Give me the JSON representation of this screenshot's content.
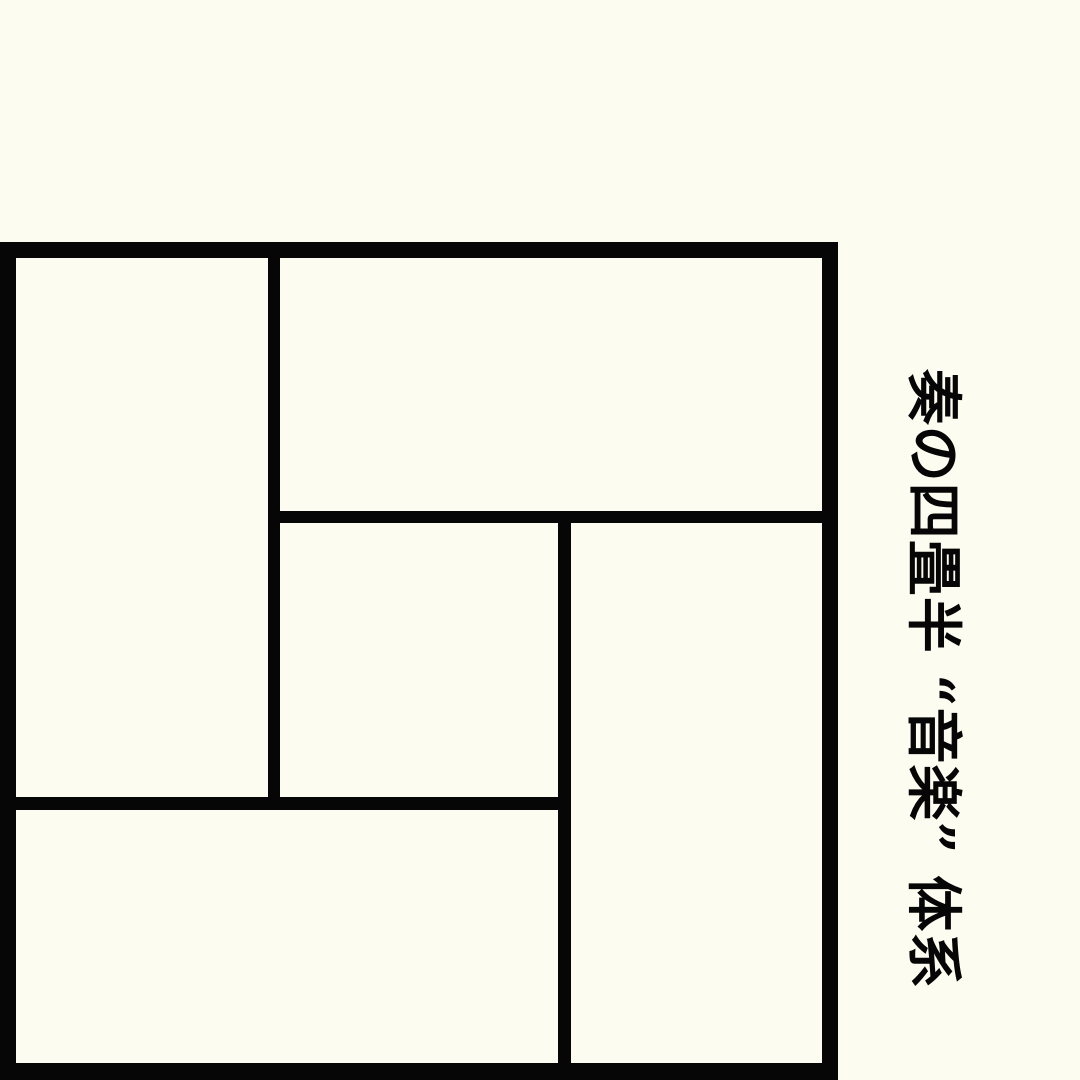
{
  "canvas": {
    "background_color": "#FDFCF0",
    "ink_color": "#060606"
  },
  "title": {
    "text": "奏の四畳半 “音楽” 体系",
    "rotation_deg": 90
  },
  "diagram": {
    "label": "yojohan-tatami-floor-plan",
    "board": {
      "left": 0,
      "top": 242,
      "width": 838,
      "height": 838
    },
    "mats": [
      {
        "name": "mat-left-full",
        "left": 16,
        "top": 16,
        "width": 252,
        "height": 539
      },
      {
        "name": "mat-top-full",
        "left": 280,
        "top": 16,
        "width": 542,
        "height": 253
      },
      {
        "name": "mat-center-half",
        "left": 280,
        "top": 281,
        "width": 278,
        "height": 274
      },
      {
        "name": "mat-right-full",
        "left": 571,
        "top": 281,
        "width": 251,
        "height": 540
      },
      {
        "name": "mat-bottom-full",
        "left": 16,
        "top": 568,
        "width": 542,
        "height": 253
      }
    ]
  }
}
